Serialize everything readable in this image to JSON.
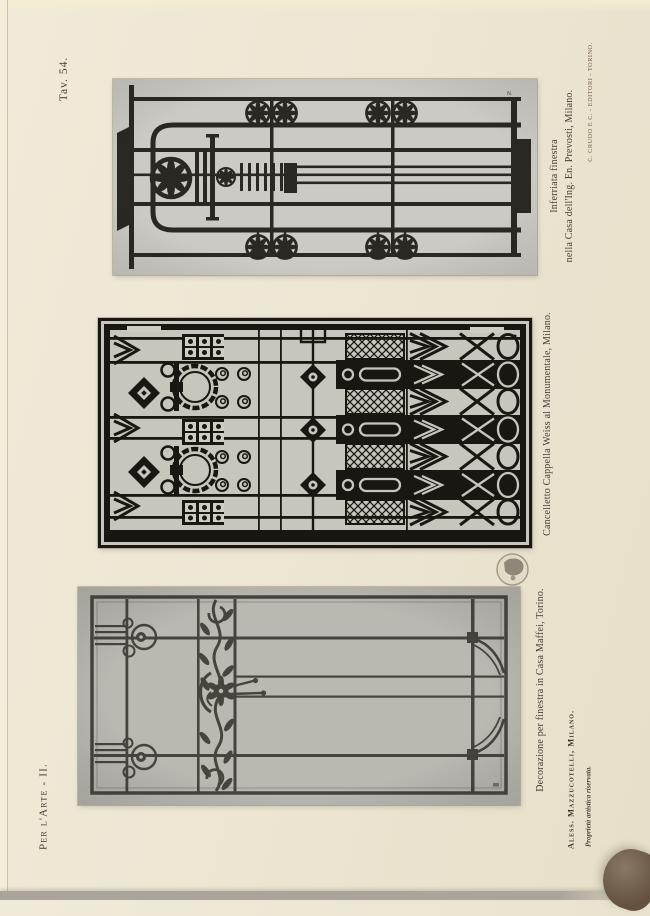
{
  "page": {
    "plate_label": "Tav. 54.",
    "series_label": "Per l'Arte - II.",
    "publisher_imprint": "C. CRUDO E C. - EDITORI - TORINO.",
    "artist_credit": "Aless. Mazzucotelli, Milano.",
    "rights_notice": "Proprietà artistica riservata."
  },
  "figures": {
    "inferriata": {
      "caption_line1": "Inferriata finestra",
      "caption_line2": "nella Casa dell'Ing. En. Prevosti, Milano.",
      "photo_mark": "N."
    },
    "cancelletto": {
      "caption": "Cancelletto Cappella Weiss al Monumentale, Milano."
    },
    "decorazione": {
      "caption": "Decorazione per finestra in Casa Maffei, Torino."
    }
  },
  "stamp": {
    "type": "library-stamp-globe"
  },
  "colors": {
    "paper": "#ece6d3",
    "ink": "#423c31",
    "imprint_ink": "#6d584a",
    "photo_inferriata_bg": "#cbcac5",
    "photo_cancelletto_bg": "#c8c5bc",
    "photo_decorazione_bg": "#b9b9b2",
    "iron": "#24201a"
  }
}
